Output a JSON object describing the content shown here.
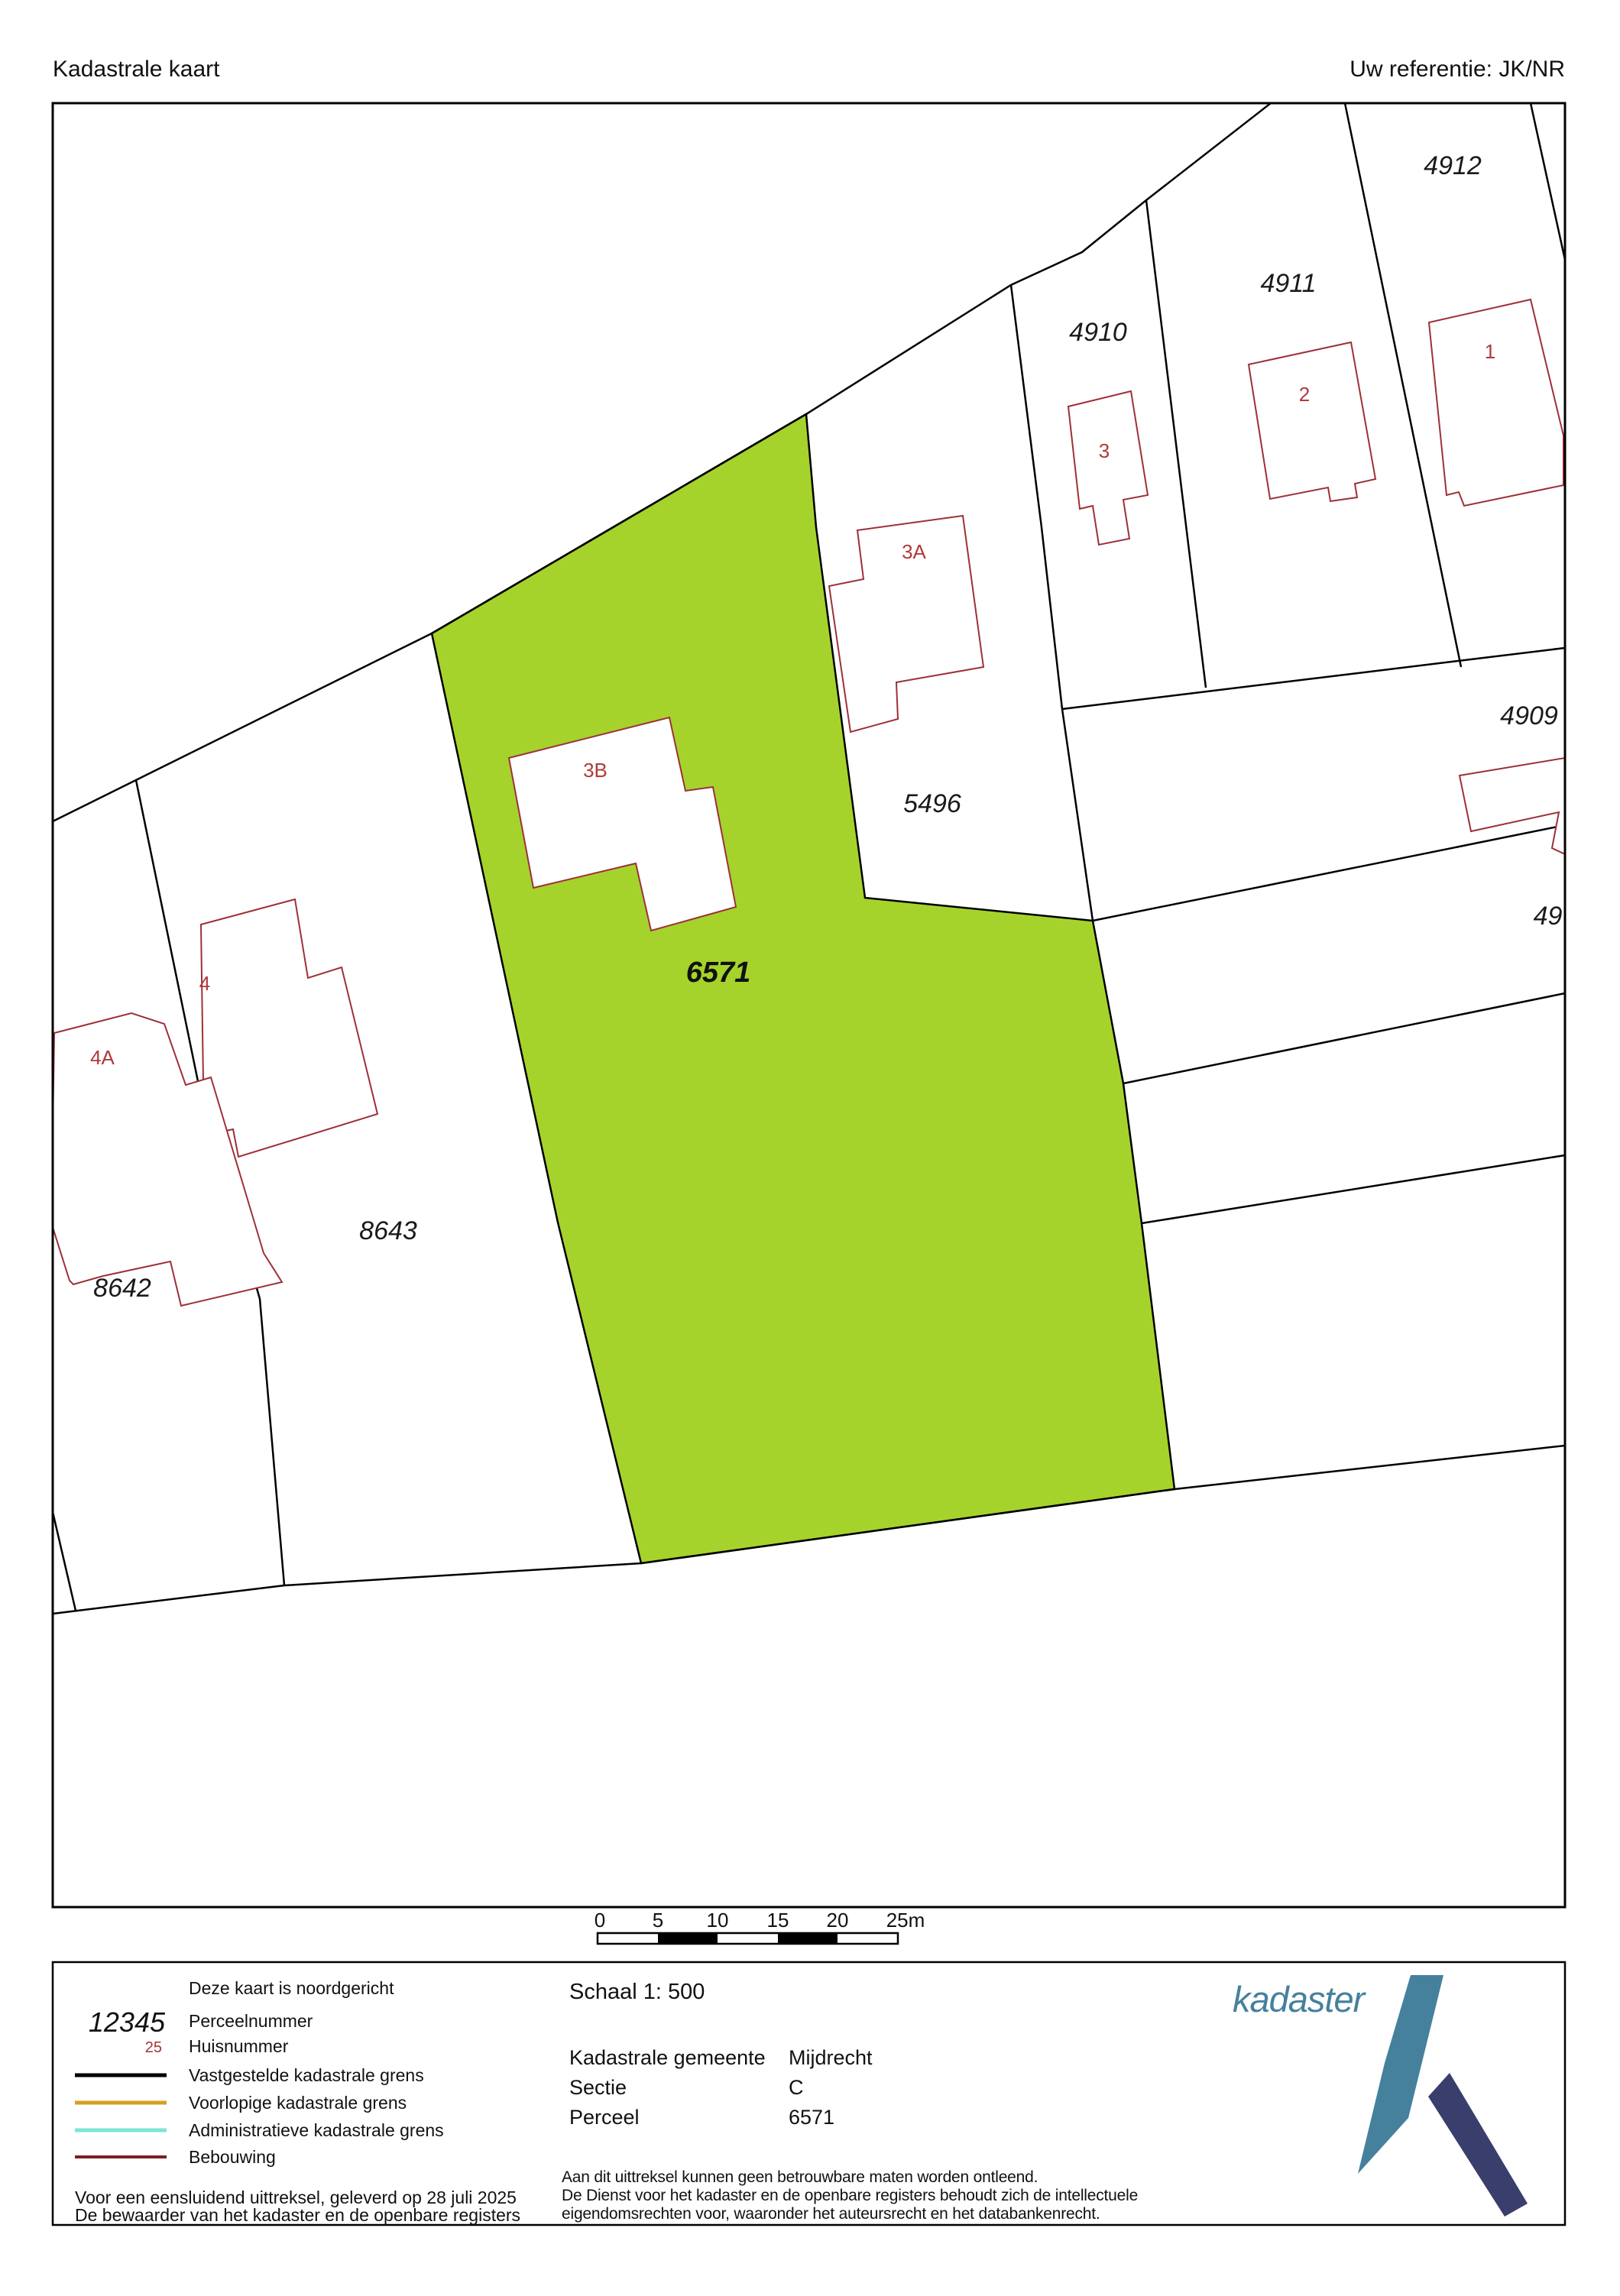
{
  "header": {
    "title": "Kadastrale kaart",
    "reference": "Uw referentie: JK/NR"
  },
  "map": {
    "highlight_color": "#a5d32c",
    "boundary_color": "#000000",
    "building_outline_color": "#9e3038",
    "house_number_color": "#b03a3a",
    "parcels": [
      {
        "label": "4912"
      },
      {
        "label": "4911"
      },
      {
        "label": "4910"
      },
      {
        "label": "4909"
      },
      {
        "label": "5496"
      },
      {
        "label": "6571",
        "highlighted": true
      },
      {
        "label": "8642"
      },
      {
        "label": "8643"
      },
      {
        "label": "496",
        "note": "clipped by map border"
      }
    ],
    "house_numbers": [
      {
        "label": "1"
      },
      {
        "label": "2"
      },
      {
        "label": "3"
      },
      {
        "label": "3A"
      },
      {
        "label": "3B"
      },
      {
        "label": "4"
      },
      {
        "label": "4A"
      }
    ]
  },
  "scale_bar": {
    "ticks": [
      "0",
      "5",
      "10",
      "15",
      "20",
      "25m"
    ]
  },
  "legend": {
    "north_note": "Deze kaart is noordgericht",
    "perceelnummer_sample": "12345",
    "perceelnummer_label": "Perceelnummer",
    "huisnummer_sample": "25",
    "huisnummer_label": "Huisnummer",
    "line_items": [
      {
        "color": "#000000",
        "label": "Vastgestelde kadastrale grens"
      },
      {
        "color": "#d7a022",
        "label": "Voorlopige kadastrale grens"
      },
      {
        "color": "#7ce6d4",
        "label": "Administratieve kadastrale grens"
      },
      {
        "color": "#7a1f28",
        "label": "Bebouwing"
      }
    ],
    "footer_line1": "Voor een eensluidend uittreksel, geleverd op 28 juli 2025",
    "footer_line2": "De bewaarder van het kadaster en de openbare registers"
  },
  "details": {
    "schaal": "Schaal 1: 500",
    "rows": [
      {
        "label": "Kadastrale gemeente",
        "value": "Mijdrecht"
      },
      {
        "label": "Sectie",
        "value": "C"
      },
      {
        "label": "Perceel",
        "value": "6571"
      }
    ],
    "disclaimer_line1": "Aan dit uittreksel kunnen geen betrouwbare maten worden ontleend.",
    "disclaimer_line2": "De Dienst voor het kadaster en de openbare registers behoudt zich de intellectuele",
    "disclaimer_line3": "eigendomsrechten voor, waaronder het auteursrecht en het databankenrecht."
  },
  "logo": {
    "wordmark": "kadaster",
    "teal": "#45819d",
    "navy": "#3a3e6c"
  }
}
